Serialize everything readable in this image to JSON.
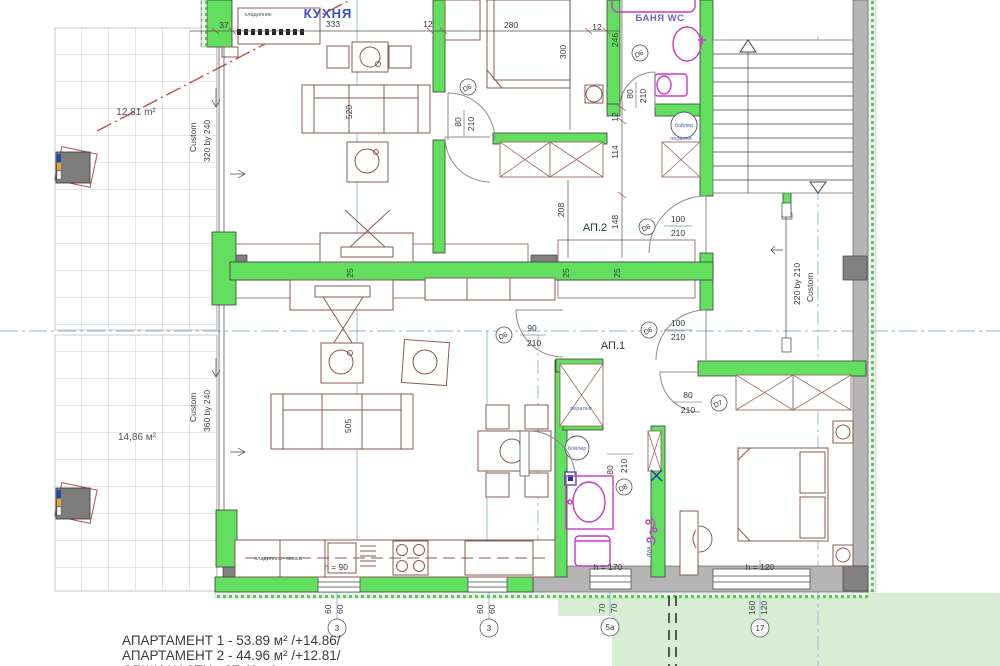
{
  "rooms": {
    "kitchen": "КУХНЯ",
    "bath2": "БАНЯ WC",
    "ap2": "АП.2",
    "ap1": "АП.1"
  },
  "terraces": {
    "top_area": "12,81 m²",
    "top_custom": "Custom",
    "top_size": "320 by 240",
    "bottom_area": "14,86 м²",
    "bottom_custom": "Custom",
    "bottom_size": "360 by 240"
  },
  "stair_opening": {
    "size": "220 by 210",
    "custom": "Custom"
  },
  "dims": {
    "d37": "37",
    "d333": "333",
    "d12a": "12",
    "d280": "280",
    "d12b": "12",
    "d246": "246",
    "d300": "300",
    "d520": "520",
    "d505": "505",
    "d12c": "12",
    "d114": "114",
    "d208": "208",
    "d148": "148",
    "d25a": "25",
    "d25b": "25",
    "d25c": "25"
  },
  "doors": {
    "kitchen": {
      "id": "D6",
      "w": "80",
      "h": "210"
    },
    "bath2": {
      "id": "D6",
      "w": "80",
      "h": "210"
    },
    "ap2_entry": {
      "id": "D6",
      "w": "100",
      "h": "210"
    },
    "ap1_entry": {
      "id": "D6",
      "w": "100",
      "h": "210"
    },
    "living": {
      "id": "D6",
      "w": "90",
      "h": "210"
    },
    "bedroom": {
      "id": "D7",
      "w": "80",
      "h": "210"
    },
    "bath1": {
      "id": "D8",
      "w": "80",
      "h": "210"
    }
  },
  "windows": {
    "counter_h": "h = 90",
    "bath_h": "h = 170",
    "bedroom_h": "h = 120"
  },
  "fixtures": {
    "fridge": "хладилник",
    "counter": "хладилник - мивка",
    "boiler": "бойлер",
    "washer": "пералня",
    "shower": "душ"
  },
  "axis_markers": {
    "a1": {
      "d1": "60",
      "d2": "60",
      "label": "3"
    },
    "a2": {
      "d1": "60",
      "d2": "60",
      "label": "3"
    },
    "a3": {
      "d1": "70",
      "d2": "70",
      "label": "5a"
    },
    "a4": {
      "d1": "160",
      "d2": "120",
      "label": "17"
    }
  },
  "legend": {
    "line1": "АПАРТАМЕНТ 1 - 53.89 м² /+14.86/",
    "line2": "АПАРТАМЕНТ 2 - 44.96 м² /+12.81/",
    "line3": "ОБЩИ ЧАСТИ - 27.49 м²"
  }
}
